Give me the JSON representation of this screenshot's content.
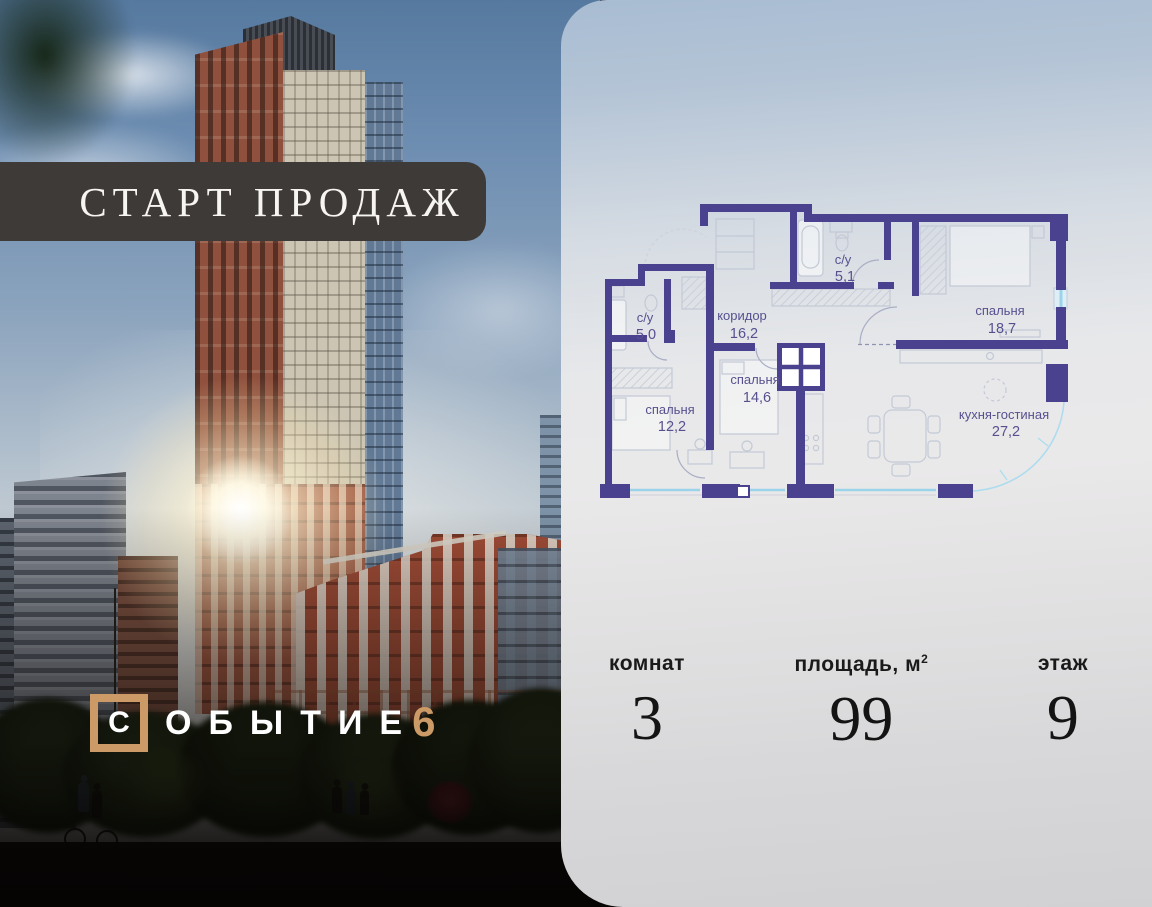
{
  "banner": {
    "label": "СТАРТ ПРОДАЖ"
  },
  "logo": {
    "letters": [
      "С",
      "О",
      "Б",
      "Ы",
      "Т",
      "И",
      "Е"
    ],
    "number": "6"
  },
  "plan": {
    "rooms": [
      {
        "name": "с/у",
        "area": "5,1"
      },
      {
        "name": "с/у",
        "area": "5,0"
      },
      {
        "name": "коридор",
        "area": "16,2"
      },
      {
        "name": "спальня",
        "area": "18,7"
      },
      {
        "name": "спальня",
        "area": "14,6"
      },
      {
        "name": "спальня",
        "area": "12,2"
      },
      {
        "name": "кухня-гостиная",
        "area": "27,2"
      }
    ]
  },
  "stats": {
    "rooms_label": "комнат",
    "rooms_value": "3",
    "area_label_base": "площадь, м",
    "area_sup": "2",
    "area_value": "99",
    "floor_label": "этаж",
    "floor_value": "9"
  },
  "colors": {
    "accent_tan": "#cb9a66",
    "banner_bg": "#3e3a37",
    "plan_wall": "#4a428e",
    "plan_label": "#57508f",
    "glazing": "#9bd4ea"
  }
}
